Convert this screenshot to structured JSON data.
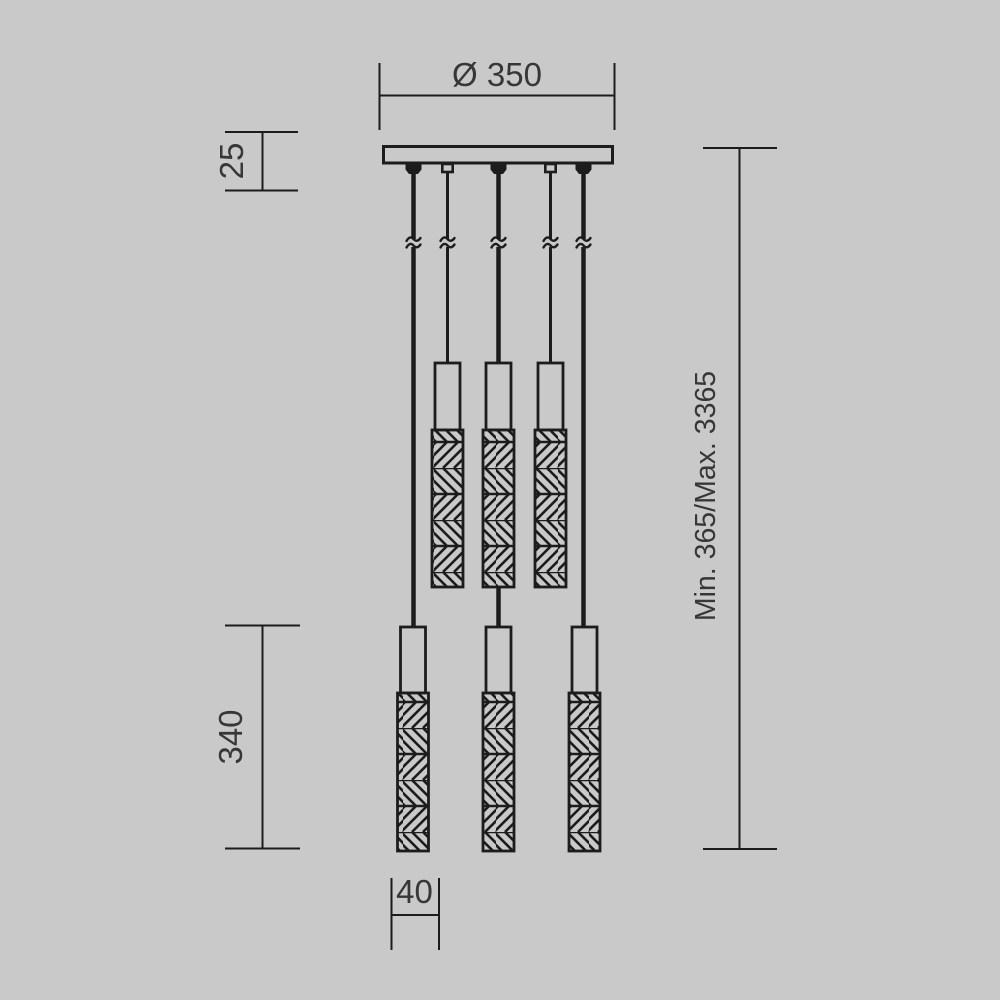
{
  "page": {
    "title": "Pendant luminaire technical dimension drawing"
  },
  "style": {
    "background_color": "#c9c9c9",
    "line_color": "#1c1c1c",
    "text_color": "#373737"
  },
  "fixture": {
    "suspension_cables": 5,
    "upper_shades": 3,
    "lower_shades": 3
  },
  "dimensions": {
    "canopy_diameter": {
      "label": "Ø 350",
      "value": 350,
      "unit": "mm"
    },
    "canopy_thickness": {
      "label": "25",
      "value": 25,
      "unit": "mm"
    },
    "suspension_height": {
      "label": "Min. 365/Max. 3365",
      "min": 365,
      "max": 3365,
      "unit": "mm"
    },
    "shade_length": {
      "label": "340",
      "value": 340,
      "unit": "mm"
    },
    "shade_width": {
      "label": "40",
      "value": 40,
      "unit": "mm"
    }
  }
}
